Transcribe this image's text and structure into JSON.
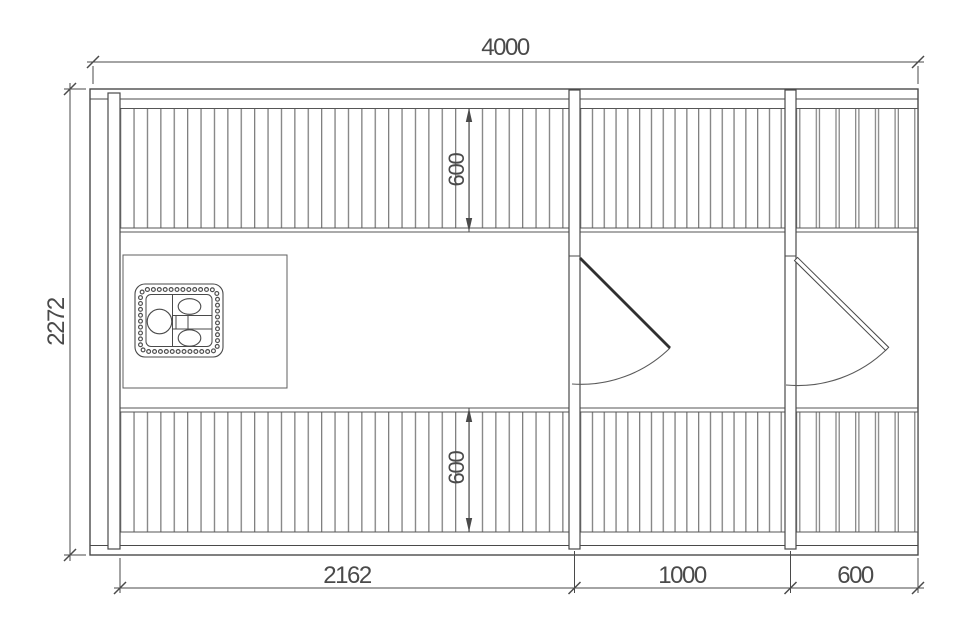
{
  "drawing": {
    "type": "sauna-cabin-floor-plan",
    "labels": {
      "dim_overall_width": "4000",
      "dim_overall_depth": "2272",
      "dim_bench_top_depth": "600",
      "dim_bench_bottom_depth": "600",
      "dim_section_left": "2162",
      "dim_section_middle": "1000",
      "dim_section_right": "600"
    },
    "colors": {
      "line": "#4a4a4a",
      "slat_line": "#7f7f7f",
      "text": "#4a4a4a",
      "background": "#ffffff"
    }
  }
}
